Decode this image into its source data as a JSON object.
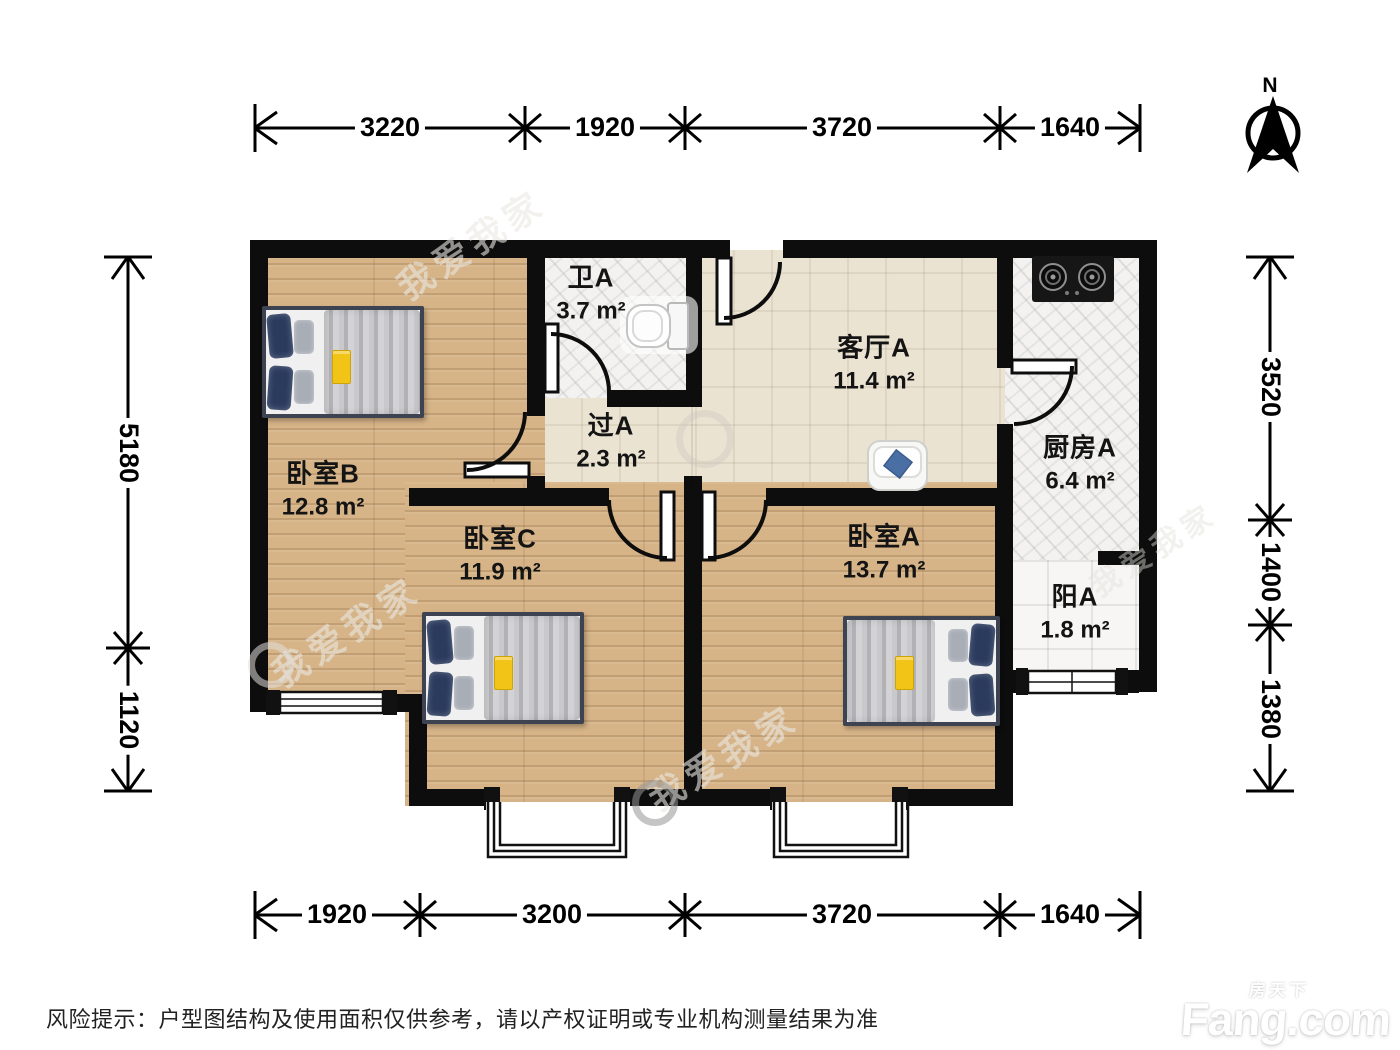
{
  "meta": {
    "disclaimer": "风险提示：户型图结构及使用面积仅供参考，请以产权证明或专业机构测量结果为准"
  },
  "compass": {
    "label": "N"
  },
  "rooms": [
    {
      "id": "bathroom-a",
      "name": "卫A",
      "area": "3.7 m²"
    },
    {
      "id": "hallway-a",
      "name": "过A",
      "area": "2.3 m²"
    },
    {
      "id": "living-a",
      "name": "客厅A",
      "area": "11.4 m²"
    },
    {
      "id": "kitchen-a",
      "name": "厨房A",
      "area": "6.4 m²"
    },
    {
      "id": "bedroom-b",
      "name": "卧室B",
      "area": "12.8 m²"
    },
    {
      "id": "bedroom-c",
      "name": "卧室C",
      "area": "11.9 m²"
    },
    {
      "id": "bedroom-a",
      "name": "卧室A",
      "area": "13.7 m²"
    },
    {
      "id": "balcony-a",
      "name": "阳A",
      "area": "1.8 m²"
    }
  ],
  "dimensions": {
    "top": [
      "3220",
      "1920",
      "3720",
      "1640"
    ],
    "bottom": [
      "1920",
      "3200",
      "3720",
      "1640"
    ],
    "left": [
      "5180",
      "1120"
    ],
    "right": [
      "3520",
      "1400",
      "1380"
    ]
  },
  "watermarks": {
    "agency": "我爱我家",
    "portal": "Fang.com",
    "portal_cn": "房天下"
  },
  "colors": {
    "wall": "#0d0d0d",
    "wood_floor": "#d6b488",
    "tile_floor": "#ebe3d2",
    "accent_yellow": "#f3c418",
    "pillow_navy": "#2b3b5e"
  }
}
